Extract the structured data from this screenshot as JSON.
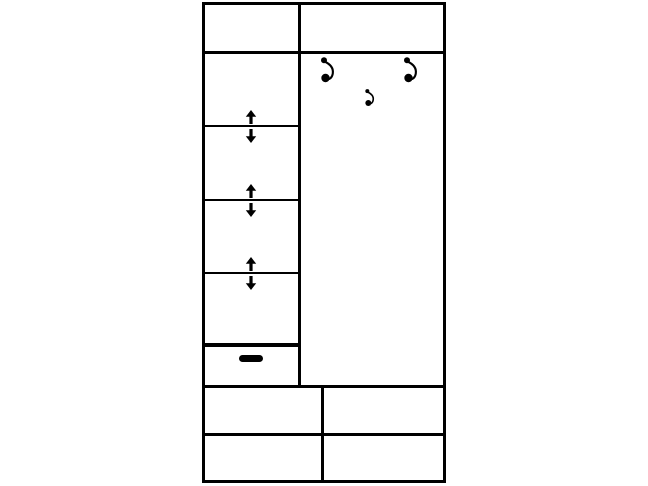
{
  "canvas": {
    "width": 648,
    "height": 486,
    "background": "#ffffff"
  },
  "diagram": {
    "type": "furniture-schematic",
    "subject": "wardrobe-front-view",
    "line_color": "#000000",
    "sections": {
      "header": {
        "cells": 2
      },
      "left_column": {
        "compartments": 4,
        "adjustable_shelf_indicators": 3,
        "small_drawer": {
          "handle": "horizontal-bar"
        }
      },
      "right_panel": {
        "coat_hooks_large": 2,
        "coat_hooks_small": 1
      },
      "bottom_section": {
        "rows": 2,
        "columns": 2,
        "drawer_cells": 4
      }
    },
    "icons": {
      "coat_hook": "coat-hook-icon",
      "shelf_arrow_up": "arrow-up-icon",
      "shelf_arrow_down": "arrow-down-icon",
      "drawer_handle": "drawer-handle-bar"
    }
  }
}
